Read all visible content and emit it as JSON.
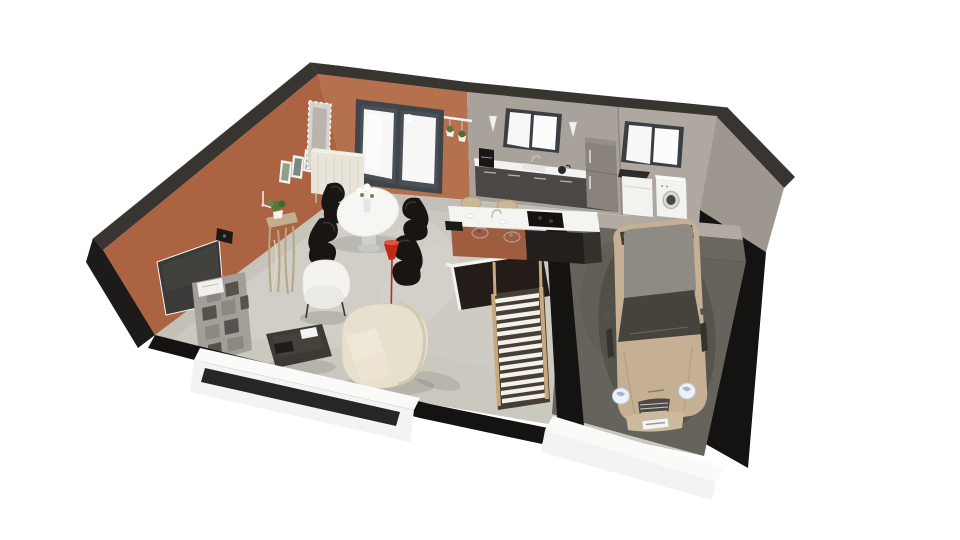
{
  "scene": {
    "kind": "3d-floor-plan-render",
    "rooms": [
      "living-room",
      "dining-area",
      "kitchen",
      "laundry-room",
      "garage",
      "basement-staircase"
    ],
    "objects": [
      "terracotta-accent-wall",
      "wall-clock",
      "wall-pictures",
      "mosaic-mirror",
      "sideboard",
      "sliding-glass-door",
      "hanging-plants",
      "flat-screen-tv",
      "wall-speaker",
      "honeycomb-shelf",
      "driftwood-console",
      "potted-plant",
      "armchair",
      "curved-sofa",
      "coffee-table",
      "tablet",
      "dining-table",
      "flower-vase",
      "panton-chairs",
      "red-floor-lamp",
      "kitchen-counter",
      "coffee-maker",
      "sink",
      "fridge",
      "kitchen-window",
      "wall-sconces",
      "kitchen-island",
      "induction-hob",
      "wire-fruit-bowls",
      "bar-stools",
      "laundry-window",
      "washing-machine",
      "tumble-dryer",
      "staircase",
      "stairwell",
      "garage-car"
    ]
  },
  "colors": {
    "background": "#ffffff",
    "wall_cap": "#38342f",
    "wall_cap_black": "#1d1b1a",
    "terracotta_left": "#ac6342",
    "terracotta_back": "#b5704e",
    "concrete_kitchen": "#a8a29b",
    "concrete_laundry": "#aea8a1",
    "concrete_right": "#9d9790",
    "wall_black": "#141312",
    "floor_main": "#cbc8c0",
    "floor_light": "#d8d5ce",
    "floor_shade": "#b7b3aa",
    "garage_floor": "#65635b",
    "garage_wall_top": "#b0aaa3",
    "garage_wall_face": "#6b665f",
    "slab_white": "#fafaf9",
    "slab_front": "#f3f3f1",
    "slab_slot": "#262624",
    "window_frame": "#3a3f45",
    "glass": "#f6f7f6",
    "door_frame": "#40454b",
    "counter_top": "#f3f3f1",
    "cabinet": "#4b4744",
    "fridge": "#8a837c",
    "island_top": "#f4f4f2",
    "island_base": "#a05c3e",
    "island_black": "#221f1c",
    "hob": "#141312",
    "appliance": "#f2f2ef",
    "table_white": "#f6f6f3",
    "chair_black": "#181512",
    "sofa_cream": "#e7e0cd",
    "armchair": "#f4f3f0",
    "coffee_table": "#35322d",
    "shelf_gray": "#a39e97",
    "shelf_hole": "#6e6a64",
    "stair_wood": "#c8a87c",
    "stair_tread": "#f1f1ee",
    "stair_back": "#493e33",
    "stairwell": "#241c18",
    "lamp_red": "#c2271a",
    "car_body": "#c6b093",
    "car_roof": "#8e8b85",
    "car_glass": "#46433d",
    "car_grille": "#4e4944",
    "plant_green": "#55793a",
    "driftwood": "#c2ad8c",
    "tv_screen": "#3a3a38",
    "console_white": "#e9e5da",
    "mirror_frame": "#d6d4cf",
    "mirror_glass": "#b9b5ae",
    "sconce": "#f1f1ee",
    "metal": "#bcbcb9"
  }
}
